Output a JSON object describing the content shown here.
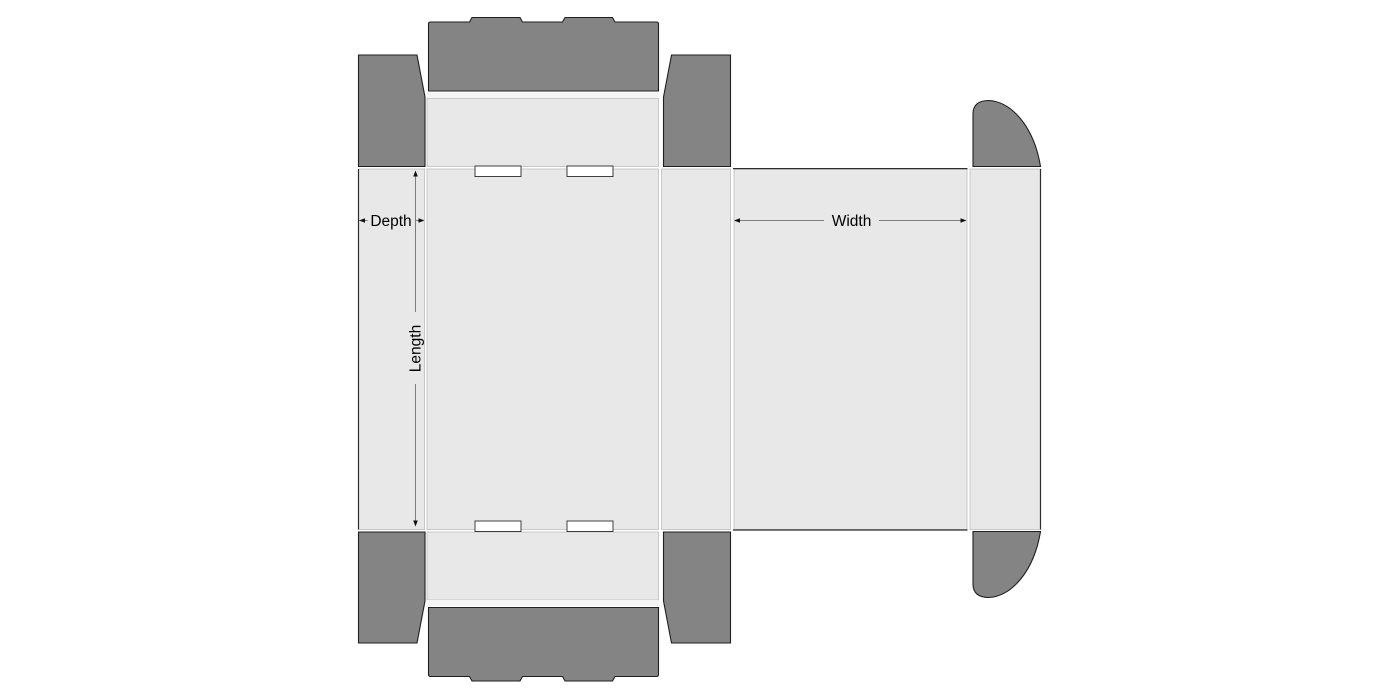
{
  "diagram": {
    "kind": "packaging-box-dieline",
    "labels": {
      "depth": "Depth",
      "length": "Length",
      "width": "Width"
    },
    "colors": {
      "background": "#ffffff",
      "panel_fill": "#e8e8e8",
      "fold_strip_fill": "#f4f4f4",
      "flap_fill": "#848484",
      "flap_outline": "#1f1f1f",
      "panel_outline": "#bdbdbd",
      "cut_line": "#2d2d2d",
      "slot_fill": "#ffffff",
      "slot_outline": "#3f3f3f",
      "dimension_line": "#7d7d7d",
      "arrowhead": "#111111",
      "label_text": "#000000"
    }
  }
}
